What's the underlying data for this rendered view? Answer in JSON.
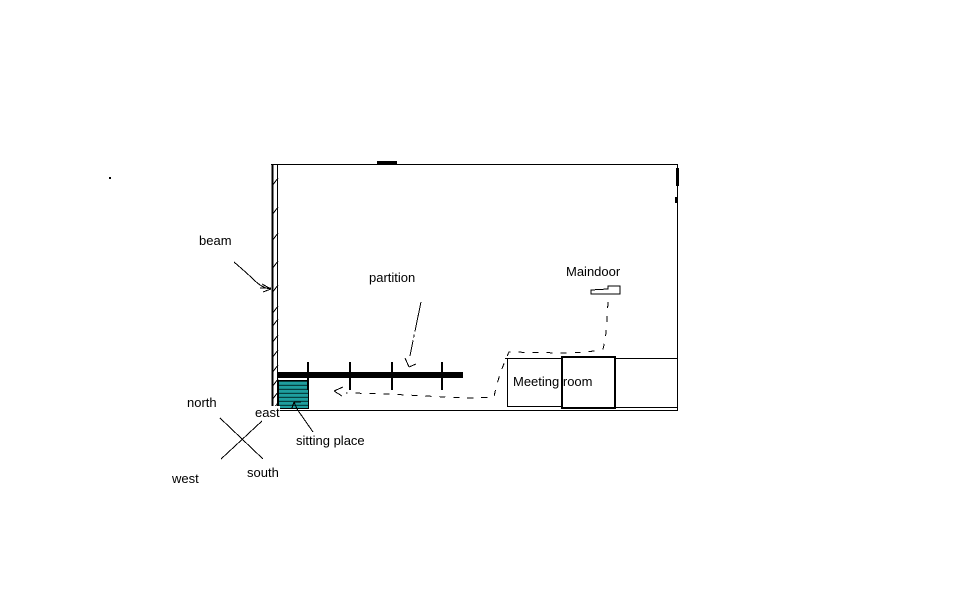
{
  "canvas": {
    "width": 955,
    "height": 591,
    "background": "#ffffff",
    "line_color": "#000000"
  },
  "labels": {
    "beam": "beam",
    "partition": "partition",
    "maindoor": "Maindoor",
    "meeting_room": "Meeting room",
    "sitting_place": "sitting place"
  },
  "compass": {
    "north": "north",
    "east": "east",
    "west": "west",
    "south": "south"
  },
  "colors": {
    "sitting_place_fill": "#1f9e9e",
    "sitting_place_stripe": "#063f3f",
    "partition_bar": "#000000"
  }
}
